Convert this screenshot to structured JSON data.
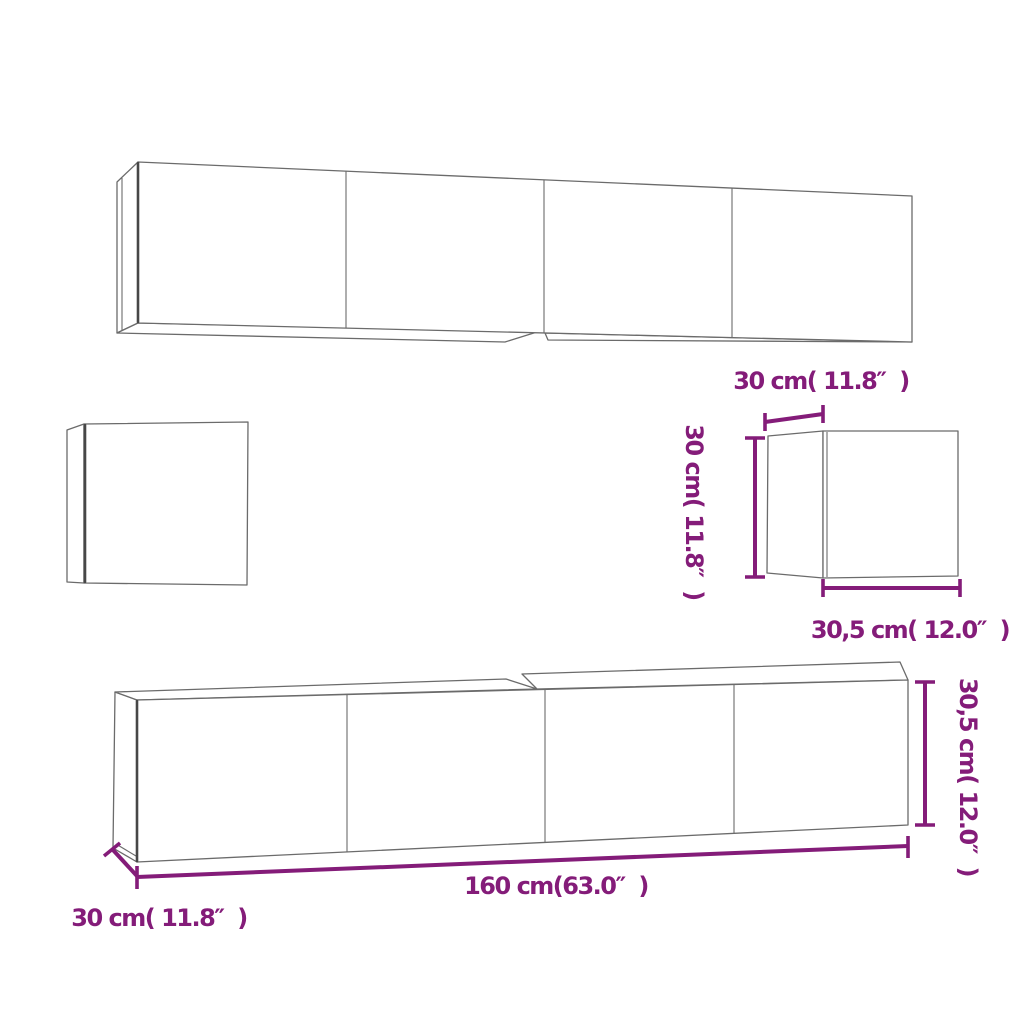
{
  "diagram": {
    "title": "TV wall cabinet set dimension diagram",
    "colors": {
      "dimension": "#841c79",
      "outline": "#6b6b6b",
      "background": "#ffffff"
    },
    "labels": {
      "top_unit_depth": "30 cm( 11.8″  )",
      "small_unit_height": "30 cm( 11.8″  )",
      "small_unit_width": "30,5 cm( 12.0″  )",
      "bottom_unit_width": "160 cm(63.0″  )",
      "bottom_unit_depth": "30 cm( 11.8″  )",
      "bottom_unit_height": "30,5 cm( 12.0″  )"
    }
  }
}
